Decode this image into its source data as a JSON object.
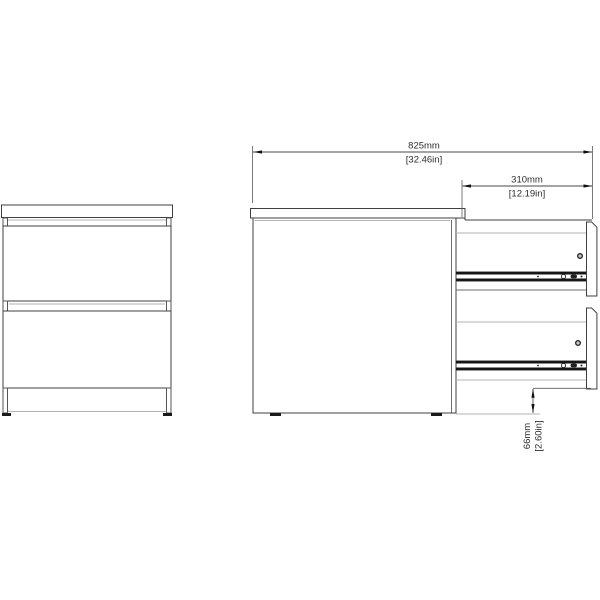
{
  "diagram": {
    "type": "furniture-dimension-drawing",
    "views": {
      "front_view_drawers": 2,
      "side_view_drawers": 2
    },
    "dims": {
      "total": {
        "metric": "825mm",
        "imperial": "[32.46in]"
      },
      "depth": {
        "metric": "310mm",
        "imperial": "[12.19in]"
      },
      "clearance": {
        "metric": "66mm",
        "imperial": "[2.60in]"
      }
    },
    "colors": {
      "background": "#ffffff",
      "outline": "#3f3f3f",
      "shadow_line": "#b3b3b3",
      "rail": "#161616",
      "feet": "#1a1a1a",
      "dimension_text": "#2e2e2e"
    }
  }
}
